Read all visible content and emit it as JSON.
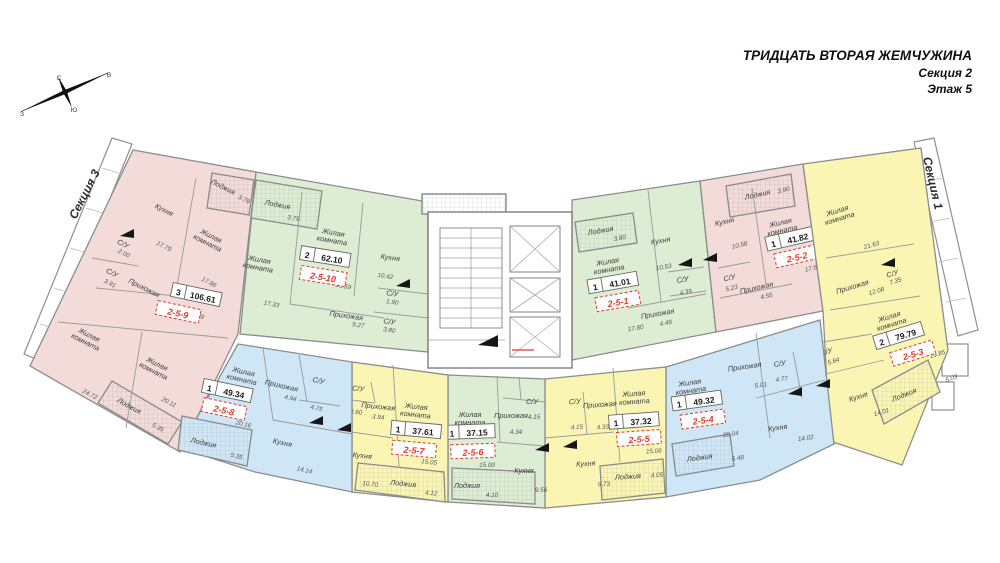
{
  "header": {
    "title": "ТРИДЦАТЬ ВТОРАЯ ЖЕМЧУЖИНА",
    "subtitle_section": "Секция 2",
    "subtitle_floor": "Этаж 5"
  },
  "neighbor_sections": {
    "left": "Секция 3",
    "right": "Секция 1"
  },
  "compass": {
    "north": "С",
    "south": "Ю",
    "east": "В",
    "west": "З"
  },
  "colors": {
    "pink": "#f2dbd9",
    "green": "#dcedd4",
    "yellow": "#fbf5b4",
    "blue": "#cfe6f7",
    "highlight_red": "#e23b2e",
    "wall": "#8c8c8c"
  },
  "apartments": [
    {
      "id": "2-5-1",
      "rooms_count": "1",
      "total_area": "41.01",
      "rooms": [
        {
          "name": "Лоджия",
          "name2": "",
          "area": "3.80"
        },
        {
          "name": "Жилая",
          "name2": "комната",
          "area": "17.80"
        },
        {
          "name": "Кухня",
          "name2": "",
          "area": "10.53"
        },
        {
          "name": "С/У",
          "name2": "",
          "area": "4.39"
        },
        {
          "name": "Прихожая",
          "name2": "",
          "area": "4.49"
        }
      ]
    },
    {
      "id": "2-5-2",
      "rooms_count": "1",
      "total_area": "41.82",
      "rooms": [
        {
          "name": "Лоджия",
          "name2": "",
          "area": "3.90"
        },
        {
          "name": "Кухня",
          "name2": "",
          "area": "10.58"
        },
        {
          "name": "Жилая",
          "name2": "комната",
          "area": "17.61"
        },
        {
          "name": "С/У",
          "name2": "",
          "area": "5.23"
        },
        {
          "name": "Прихожая",
          "name2": "",
          "area": "4.55"
        }
      ]
    },
    {
      "id": "2-5-3",
      "rooms_count": "2",
      "total_area": "79.79",
      "rooms": [
        {
          "name": "Жилая",
          "name2": "комната",
          "area": "21.63"
        },
        {
          "name": "Прихожая",
          "name2": "",
          "area": "12.08"
        },
        {
          "name": "С/У",
          "name2": "",
          "area": "7.35"
        },
        {
          "name": "С/У",
          "name2": "",
          "area": "5.84"
        },
        {
          "name": "Жилая",
          "name2": "комната",
          "area": "19.85"
        },
        {
          "name": "Кухня",
          "name2": "",
          "area": "14.01"
        },
        {
          "name": "Лоджия",
          "name2": "",
          "area": "5.03"
        }
      ]
    },
    {
      "id": "2-5-4",
      "rooms_count": "1",
      "total_area": "49.32",
      "rooms": [
        {
          "name": "Жилая",
          "name2": "комната",
          "area": "20.04"
        },
        {
          "name": "Прихожая",
          "name2": "",
          "area": "5.01"
        },
        {
          "name": "С/У",
          "name2": "",
          "area": "4.77"
        },
        {
          "name": "Кухня",
          "name2": "",
          "area": "14.02"
        },
        {
          "name": "Лоджия",
          "name2": "",
          "area": "5.48"
        }
      ]
    },
    {
      "id": "2-5-5",
      "rooms_count": "1",
      "total_area": "37.32",
      "rooms": [
        {
          "name": "С/У",
          "name2": "",
          "area": "4.15"
        },
        {
          "name": "Прихожая",
          "name2": "",
          "area": "4.33"
        },
        {
          "name": "Жилая",
          "name2": "комната",
          "area": "15.06"
        },
        {
          "name": "Кухня",
          "name2": "",
          "area": "9.73"
        },
        {
          "name": "Лоджия",
          "name2": "",
          "area": "4.05"
        }
      ]
    },
    {
      "id": "2-5-6",
      "rooms_count": "1",
      "total_area": "37.15",
      "rooms": [
        {
          "name": "Жилая",
          "name2": "комната",
          "area": "15.00"
        },
        {
          "name": "Прихожая",
          "name2": "",
          "area": "4.34"
        },
        {
          "name": "С/У",
          "name2": "",
          "area": "4.15"
        },
        {
          "name": "Кухня",
          "name2": "",
          "area": "9.56"
        },
        {
          "name": "Лоджия",
          "name2": "",
          "area": "4.10"
        }
      ]
    },
    {
      "id": "2-5-7",
      "rooms_count": "1",
      "total_area": "37.61",
      "rooms": [
        {
          "name": "С/У",
          "name2": "",
          "area": "3.60"
        },
        {
          "name": "Прихожая",
          "name2": "",
          "area": "3.94"
        },
        {
          "name": "Жилая",
          "name2": "комната",
          "area": "15.05"
        },
        {
          "name": "Кухня",
          "name2": "",
          "area": "10.70"
        },
        {
          "name": "Лоджия",
          "name2": "",
          "area": "4.12"
        }
      ]
    },
    {
      "id": "2-5-8",
      "rooms_count": "1",
      "total_area": "49.34",
      "rooms": [
        {
          "name": "Жилая",
          "name2": "комната",
          "area": "20.16"
        },
        {
          "name": "Прихожая",
          "name2": "",
          "area": "4.94"
        },
        {
          "name": "С/У",
          "name2": "",
          "area": "4.75"
        },
        {
          "name": "Кухня",
          "name2": "",
          "area": "14.14"
        },
        {
          "name": "Лоджия",
          "name2": "",
          "area": "5.35"
        }
      ]
    },
    {
      "id": "2-5-9",
      "rooms_count": "3",
      "total_area": "106.61",
      "rooms": [
        {
          "name": "Кухня",
          "name2": "",
          "area": "17.79"
        },
        {
          "name": "Лоджия",
          "name2": "",
          "area": "3.78"
        },
        {
          "name": "Жилая",
          "name2": "комната",
          "area": "17.86"
        },
        {
          "name": "С/У",
          "name2": "",
          "area": "2.00"
        },
        {
          "name": "С/У",
          "name2": "",
          "area": "3.91"
        },
        {
          "name": "Прихожая",
          "name2": "",
          "area": "11.29"
        },
        {
          "name": "Жилая",
          "name2": "комната",
          "area": "24.72"
        },
        {
          "name": "Жилая",
          "name2": "комната",
          "area": "20.11"
        },
        {
          "name": "Лоджия",
          "name2": "",
          "area": "5.35"
        }
      ]
    },
    {
      "id": "2-5-10",
      "rooms_count": "2",
      "total_area": "62.10",
      "rooms": [
        {
          "name": "Лоджия",
          "name2": "",
          "area": "3.79"
        },
        {
          "name": "Жилая",
          "name2": "комната",
          "area": "17.33"
        },
        {
          "name": "Жилая",
          "name2": "комната",
          "area": "15.59"
        },
        {
          "name": "Кухня",
          "name2": "",
          "area": "10.42"
        },
        {
          "name": "С/У",
          "name2": "",
          "area": "1.90"
        },
        {
          "name": "С/У",
          "name2": "",
          "area": "3.80"
        },
        {
          "name": "Прихожая",
          "name2": "",
          "area": "9.27"
        }
      ]
    }
  ]
}
